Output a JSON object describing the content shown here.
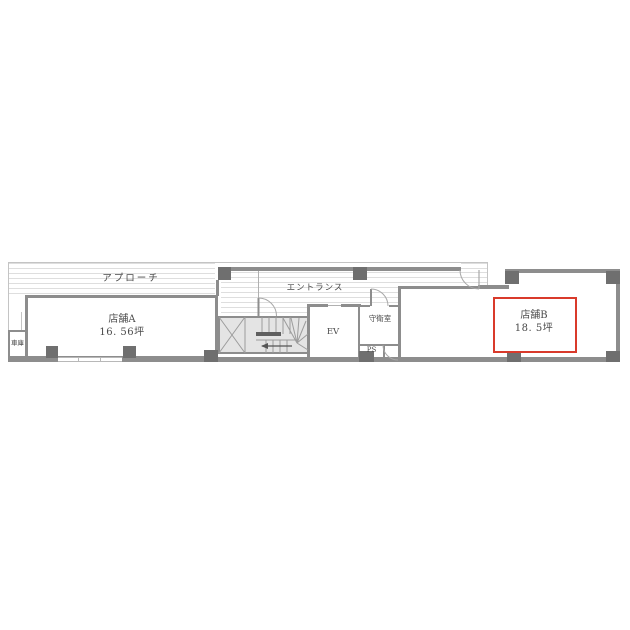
{
  "plan": {
    "areas": {
      "approach": {
        "label": "アプローチ"
      },
      "entrance": {
        "label": "エントランス"
      },
      "store_a": {
        "name": "店舗A",
        "area": "16. 56坪"
      },
      "store_b": {
        "name": "店舗B",
        "area": "18. 5坪",
        "highlighted": true
      },
      "elevator": {
        "label": "EV"
      },
      "guard_room": {
        "label": "守衛室"
      },
      "pipe_space": {
        "label": "PS"
      },
      "garage": {
        "label": "車庫"
      }
    },
    "colors": {
      "wall": "#8d8d8d",
      "pillar": "#6f6f6f",
      "highlight": "#d93a2b",
      "stair_fill": "#e4e4e4",
      "hatch_line": "#dedede",
      "line": "#c4c4c4",
      "text": "#4a4a4a"
    }
  }
}
